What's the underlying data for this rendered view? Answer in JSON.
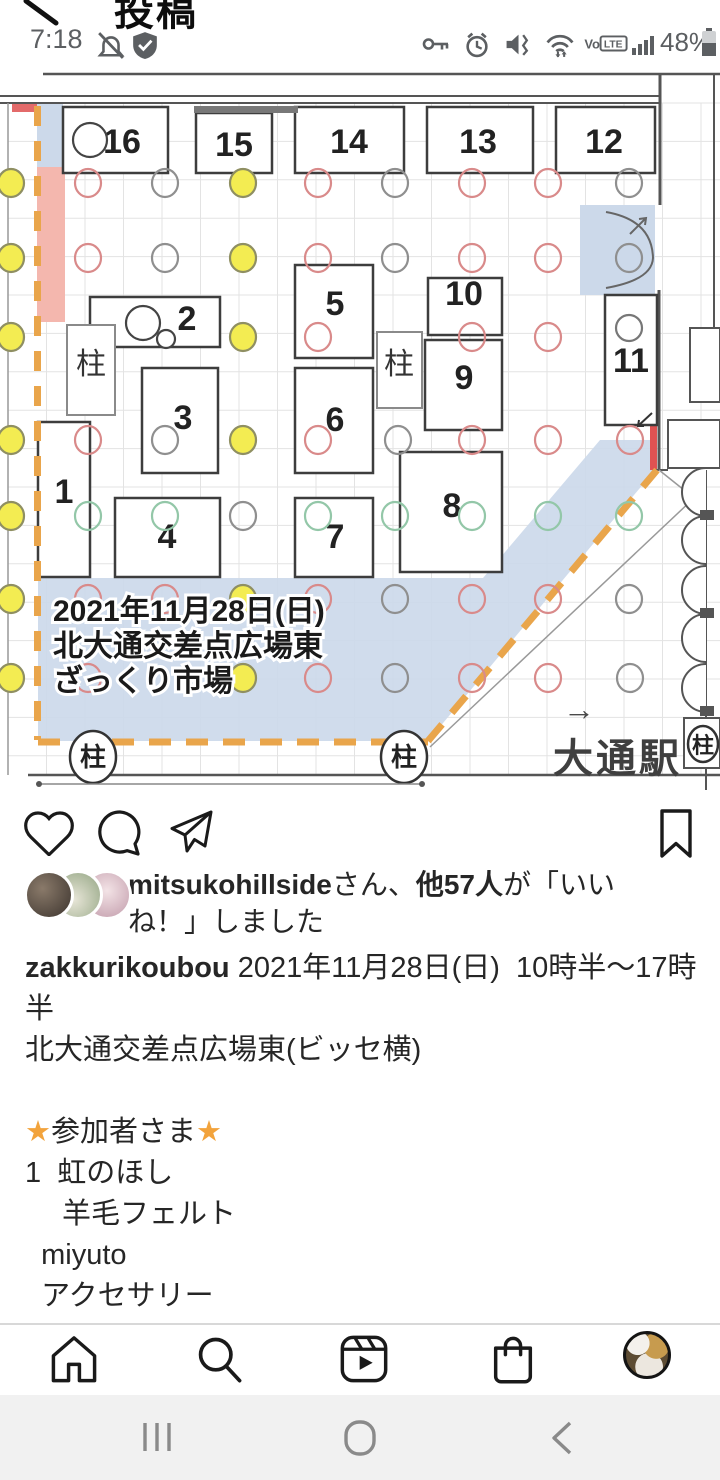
{
  "status_bar": {
    "time": "7:18",
    "battery_percent": "48%",
    "left_icons": [
      "alarm-off-icon",
      "shield-check-icon"
    ],
    "right_icons": [
      "key-icon",
      "alarm-icon",
      "vibrate-mute-icon",
      "wifi-icon",
      "volte-badge",
      "signal-bars-icon",
      "battery-icon"
    ],
    "volte_label": "VoLTE"
  },
  "header": {
    "title": "投稿",
    "back_icon": "back-chevron"
  },
  "post_image": {
    "map": {
      "colors": {
        "yellow": "#f3ec52",
        "red": "#d98a8a",
        "green": "#93c7a8",
        "gray": "#8f8f8f",
        "blue": "#ccd9ea",
        "pink": "#f4b7ae",
        "orange": "#e9a54b",
        "wall": "#555555"
      },
      "pillar_label": "柱",
      "booths": [
        [
          "16",
          63,
          35,
          105,
          66,
          122,
          81
        ],
        [
          "15",
          196,
          41,
          76,
          60,
          234,
          84
        ],
        [
          "14",
          295,
          35,
          109,
          66,
          349,
          81
        ],
        [
          "13",
          427,
          35,
          106,
          66,
          478,
          81
        ],
        [
          "12",
          556,
          35,
          99,
          66,
          604,
          81
        ],
        [
          "2",
          90,
          225,
          130,
          50,
          187,
          258
        ],
        [
          "3",
          142,
          296,
          76,
          105,
          183,
          357
        ],
        [
          "1",
          38,
          350,
          52,
          155,
          64,
          431
        ],
        [
          "4",
          115,
          426,
          105,
          79,
          167,
          476
        ],
        [
          "5",
          295,
          193,
          78,
          93,
          335,
          243
        ],
        [
          "6",
          295,
          296,
          78,
          105,
          335,
          359
        ],
        [
          "7",
          295,
          426,
          78,
          79,
          335,
          476
        ],
        [
          "10",
          428,
          206,
          74,
          57,
          464,
          233
        ],
        [
          "9",
          425,
          268,
          77,
          90,
          464,
          317
        ],
        [
          "8",
          400,
          380,
          102,
          120,
          452,
          445
        ],
        [
          "11",
          605,
          223,
          52,
          130,
          631,
          300
        ]
      ],
      "pillar_boxes": [
        [
          67,
          253,
          48,
          90,
          91,
          302
        ],
        [
          377,
          260,
          45,
          76,
          399,
          302
        ]
      ],
      "pillar_stamps": [
        [
          93,
          685,
          23,
          26
        ],
        [
          404,
          685,
          23,
          26
        ],
        [
          703,
          672,
          15,
          18
        ]
      ],
      "circles": [
        [
          11,
          111,
          "Y"
        ],
        [
          88,
          111,
          "R"
        ],
        [
          165,
          111,
          "N"
        ],
        [
          243,
          111,
          "Y"
        ],
        [
          318,
          111,
          "R"
        ],
        [
          395,
          111,
          "N"
        ],
        [
          472,
          111,
          "R"
        ],
        [
          548,
          111,
          "R"
        ],
        [
          629,
          111,
          "N"
        ],
        [
          11,
          186,
          "Y"
        ],
        [
          88,
          186,
          "R"
        ],
        [
          165,
          186,
          "N"
        ],
        [
          243,
          186,
          "Y"
        ],
        [
          318,
          186,
          "R"
        ],
        [
          395,
          186,
          "N"
        ],
        [
          472,
          186,
          "R"
        ],
        [
          548,
          186,
          "R"
        ],
        [
          629,
          186,
          "N"
        ],
        [
          11,
          265,
          "Y"
        ],
        [
          243,
          265,
          "Y"
        ],
        [
          318,
          265,
          "R"
        ],
        [
          472,
          265,
          "R"
        ],
        [
          548,
          265,
          "R"
        ],
        [
          11,
          368,
          "Y"
        ],
        [
          88,
          368,
          "R"
        ],
        [
          165,
          368,
          "N"
        ],
        [
          243,
          368,
          "Y"
        ],
        [
          318,
          368,
          "R"
        ],
        [
          398,
          368,
          "N"
        ],
        [
          472,
          368,
          "R"
        ],
        [
          548,
          368,
          "R"
        ],
        [
          630,
          368,
          "R"
        ],
        [
          11,
          444,
          "Y"
        ],
        [
          88,
          444,
          "G"
        ],
        [
          165,
          444,
          "G"
        ],
        [
          243,
          444,
          "N"
        ],
        [
          318,
          444,
          "G"
        ],
        [
          395,
          444,
          "G"
        ],
        [
          472,
          444,
          "G"
        ],
        [
          548,
          444,
          "G"
        ],
        [
          629,
          444,
          "G"
        ],
        [
          11,
          527,
          "Y"
        ],
        [
          88,
          527,
          "R"
        ],
        [
          165,
          527,
          "R"
        ],
        [
          243,
          527,
          "Y"
        ],
        [
          318,
          527,
          "R"
        ],
        [
          395,
          527,
          "N"
        ],
        [
          472,
          527,
          "R"
        ],
        [
          548,
          527,
          "R"
        ],
        [
          629,
          527,
          "N"
        ],
        [
          11,
          606,
          "Y"
        ],
        [
          88,
          606,
          "R"
        ],
        [
          243,
          606,
          "Y"
        ],
        [
          318,
          606,
          "R"
        ],
        [
          395,
          606,
          "N"
        ],
        [
          472,
          606,
          "R"
        ],
        [
          548,
          606,
          "R"
        ],
        [
          630,
          606,
          "N"
        ]
      ],
      "booth_circles": [
        [
          90,
          68,
          17,
          "#444444"
        ],
        [
          143,
          251,
          17,
          "#444444"
        ],
        [
          166,
          267,
          9,
          "#444444"
        ],
        [
          629,
          256,
          13,
          "#777777"
        ]
      ],
      "annotation": {
        "x": 53,
        "lines": [
          "2021年11月28日(日)",
          "北大通交差点広場東",
          "ざっくり市場"
        ],
        "ys": [
          549,
          584,
          619
        ]
      },
      "station": {
        "arrow": "→",
        "label": "大通駅"
      }
    }
  },
  "actions": {
    "icons": [
      "heart-icon",
      "comment-icon",
      "share-icon",
      "bookmark-icon"
    ]
  },
  "likes": {
    "avatars": [
      "liker-avatar-1",
      "liker-avatar-2",
      "liker-avatar-3"
    ],
    "segments": [
      {
        "t": "mitsukohillside",
        "s": "b"
      },
      {
        "t": "さん、",
        "s": "n"
      },
      {
        "t": "他57人",
        "s": "b"
      },
      {
        "t": "が「いいね！」しました",
        "s": "n"
      }
    ]
  },
  "caption": {
    "lines": [
      [
        {
          "t": "zakkurikoubou",
          "s": "b"
        },
        {
          "t": " 2021年11月28日(日)  10時半〜17時半",
          "s": "n"
        }
      ],
      [
        {
          "t": "北大通交差点広場東(ビッセ横)",
          "s": "n"
        }
      ],
      [
        {
          "t": "",
          "s": "n"
        }
      ],
      [
        {
          "t": "★",
          "s": "star"
        },
        {
          "t": "参加者さま",
          "s": "n"
        },
        {
          "t": "★",
          "s": "star"
        }
      ],
      [
        {
          "t": "1  虹のほし",
          "s": "n"
        }
      ],
      [
        {
          "t": "　 羊毛フェルト",
          "s": "n"
        }
      ],
      [
        {
          "t": "  miyuto",
          "s": "n"
        }
      ],
      [
        {
          "t": "  アクセサリー",
          "s": "n"
        }
      ]
    ]
  },
  "bottom_nav": {
    "icons": [
      "home-icon",
      "search-icon",
      "reels-icon",
      "shop-bag-icon",
      "profile-avatar"
    ]
  },
  "android_nav": {
    "icons": [
      "recents-icon",
      "home-pill-icon",
      "back-icon"
    ]
  }
}
